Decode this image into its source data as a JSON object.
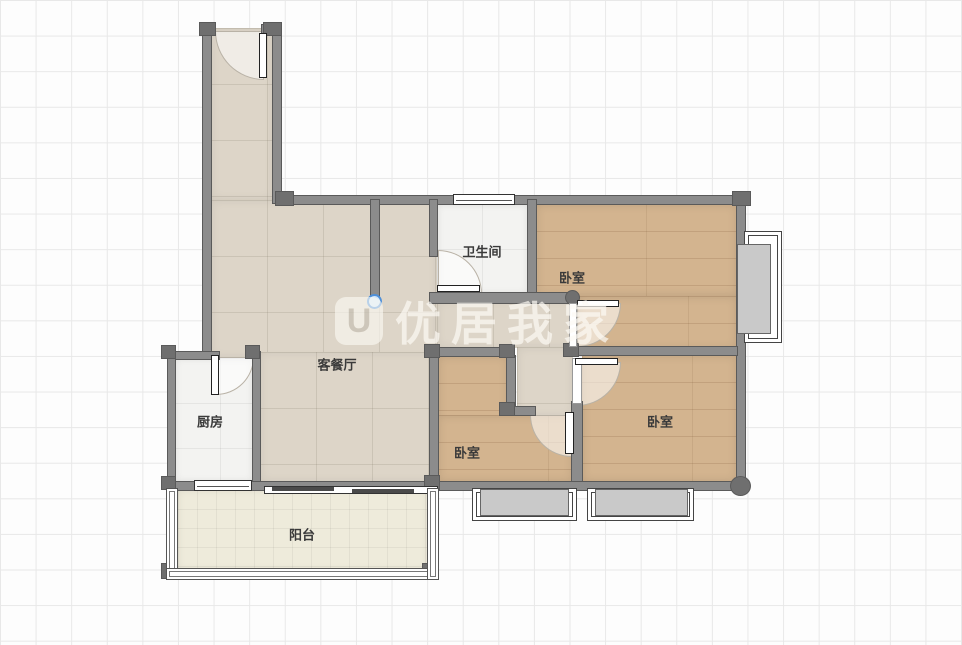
{
  "watermark": {
    "logo": "U",
    "text": "优居我家"
  },
  "rooms": [
    {
      "id": "bathroom",
      "label": "卫生间"
    },
    {
      "id": "bedroom-top-right",
      "label": "卧室"
    },
    {
      "id": "living-dining",
      "label": "客餐厅"
    },
    {
      "id": "kitchen",
      "label": "厨房"
    },
    {
      "id": "bedroom-middle",
      "label": "卧室"
    },
    {
      "id": "bedroom-bottom-right",
      "label": "卧室"
    },
    {
      "id": "balcony",
      "label": "阳台"
    }
  ],
  "colors": {
    "wall": "#8c8c8c",
    "wallDark": "#6f6f6f",
    "wallOutline": "#5a5a5a",
    "wood": "#d3b48f",
    "tile": "#ddd5c8",
    "whiteTile": "#f3f3f1",
    "balconyFloor": "#eeebdb",
    "accent": "#4e8fd8",
    "label": "#3a3a3a",
    "grid": "#e8e8e8",
    "canvas": "#fdfdfd"
  }
}
